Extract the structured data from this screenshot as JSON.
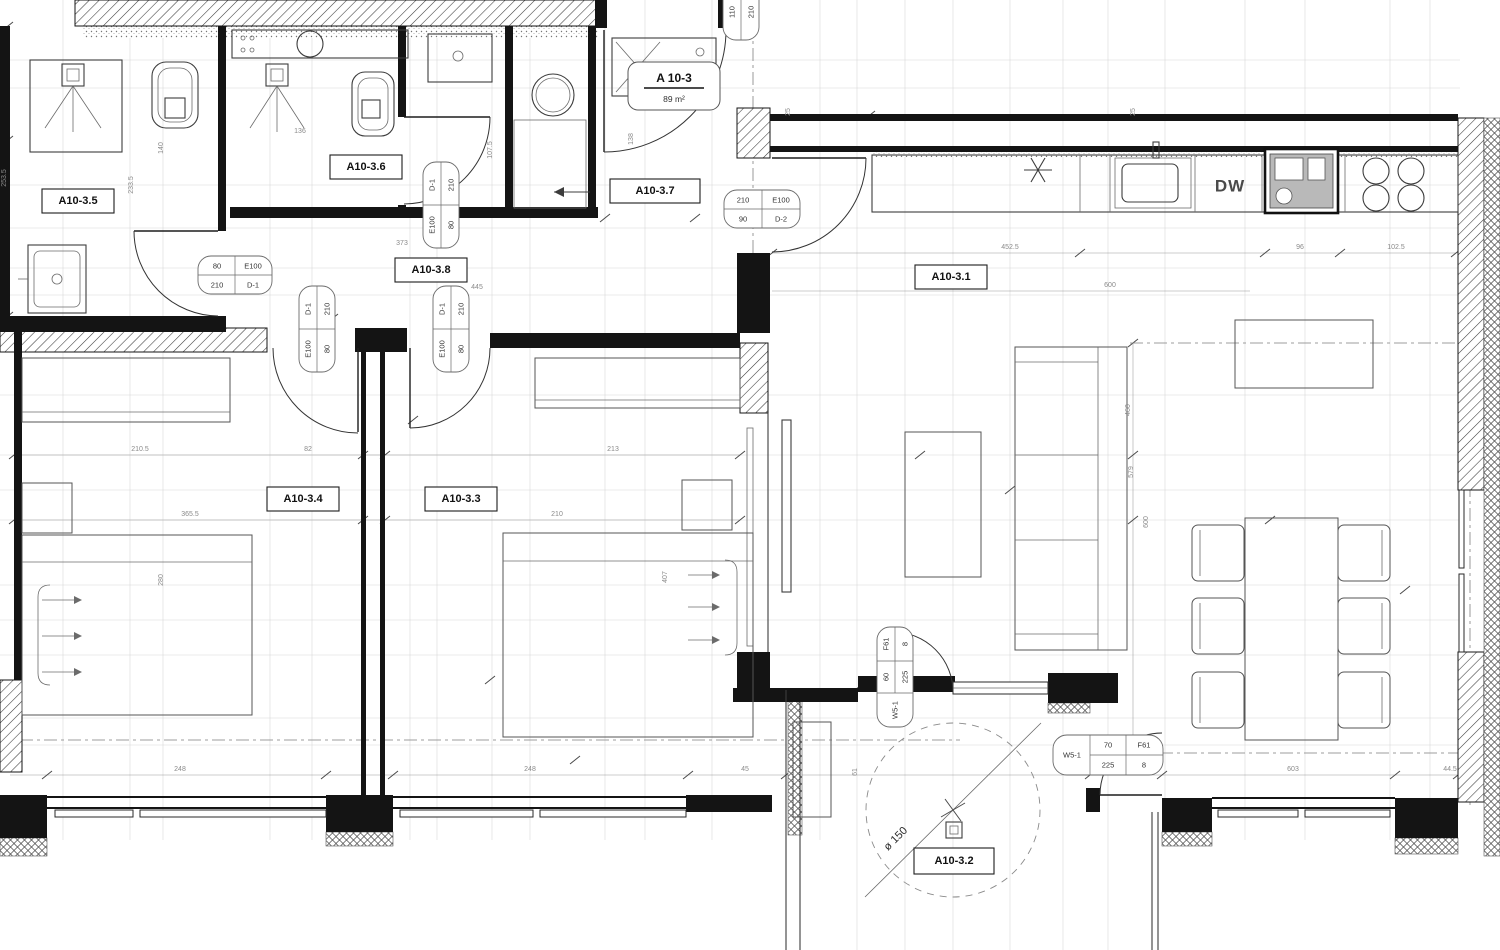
{
  "unit": {
    "name": "A 10-3",
    "area": "89 m²"
  },
  "rooms": [
    {
      "label": "A10-3.5"
    },
    {
      "label": "A10-3.6"
    },
    {
      "label": "A10-3.7"
    },
    {
      "label": "A10-3.8"
    },
    {
      "label": "A10-3.4"
    },
    {
      "label": "A10-3.3"
    },
    {
      "label": "A10-3.1"
    },
    {
      "label": "A10-3.2"
    }
  ],
  "door_labels": [
    {
      "w": "80",
      "type": "E100",
      "h": "210",
      "code": "D-1"
    },
    {
      "w": "210",
      "type": "E100",
      "h": "90",
      "code": "D-2"
    },
    {
      "w": "110",
      "h": "210"
    },
    {
      "name": "W5-1",
      "w": "60",
      "h": "225",
      "type": "F61",
      "code": "8"
    },
    {
      "name": "W5-1",
      "w": "70",
      "h": "225",
      "type": "F61",
      "code": "8"
    }
  ],
  "kitchen": {
    "dishwasher_label": "DW"
  },
  "balcony": {
    "diameter_label": "ø 150"
  },
  "dimensions": [
    {
      "x": 140,
      "y": 451,
      "r": 0,
      "t": "210.5"
    },
    {
      "x": 308,
      "y": 451,
      "r": 0,
      "t": "82"
    },
    {
      "x": 613,
      "y": 451,
      "r": 0,
      "t": "213"
    },
    {
      "x": 190,
      "y": 516,
      "r": 0,
      "t": "365.5"
    },
    {
      "x": 557,
      "y": 516,
      "r": 0,
      "t": "210"
    },
    {
      "x": 180,
      "y": 771,
      "r": 0,
      "t": "248"
    },
    {
      "x": 530,
      "y": 771,
      "r": 0,
      "t": "248"
    },
    {
      "x": 745,
      "y": 771,
      "r": 0,
      "t": "45"
    },
    {
      "x": 1293,
      "y": 771,
      "r": 0,
      "t": "603"
    },
    {
      "x": 1450,
      "y": 771,
      "r": 0,
      "t": "44.5"
    },
    {
      "x": 1010,
      "y": 249,
      "r": 0,
      "t": "452.5"
    },
    {
      "x": 1300,
      "y": 249,
      "r": 0,
      "t": "96"
    },
    {
      "x": 1396,
      "y": 249,
      "r": 0,
      "t": "102.5"
    },
    {
      "x": 1110,
      "y": 287,
      "r": 0,
      "t": "600"
    },
    {
      "x": 402,
      "y": 245,
      "r": 0,
      "t": "373"
    },
    {
      "x": 477,
      "y": 289,
      "r": 0,
      "t": "445"
    },
    {
      "x": 300,
      "y": 133,
      "r": 0,
      "t": "136"
    },
    {
      "x": 6,
      "y": 178,
      "r": -90,
      "t": "253.5"
    },
    {
      "x": 133,
      "y": 185,
      "r": -90,
      "t": "233.5"
    },
    {
      "x": 163,
      "y": 148,
      "r": -90,
      "t": "140"
    },
    {
      "x": 492,
      "y": 150,
      "r": -90,
      "t": "107.5"
    },
    {
      "x": 633,
      "y": 139,
      "r": -90,
      "t": "138"
    },
    {
      "x": 1133,
      "y": 472,
      "r": -90,
      "t": "579"
    },
    {
      "x": 1130,
      "y": 410,
      "r": -90,
      "t": "460"
    },
    {
      "x": 1148,
      "y": 522,
      "r": -90,
      "t": "600"
    },
    {
      "x": 667,
      "y": 577,
      "r": -90,
      "t": "407"
    },
    {
      "x": 163,
      "y": 580,
      "r": -90,
      "t": "280"
    },
    {
      "x": 857,
      "y": 772,
      "r": -90,
      "t": "61"
    },
    {
      "x": 790,
      "y": 112,
      "r": -90,
      "t": "25"
    },
    {
      "x": 1135,
      "y": 112,
      "r": -90,
      "t": "25"
    }
  ]
}
